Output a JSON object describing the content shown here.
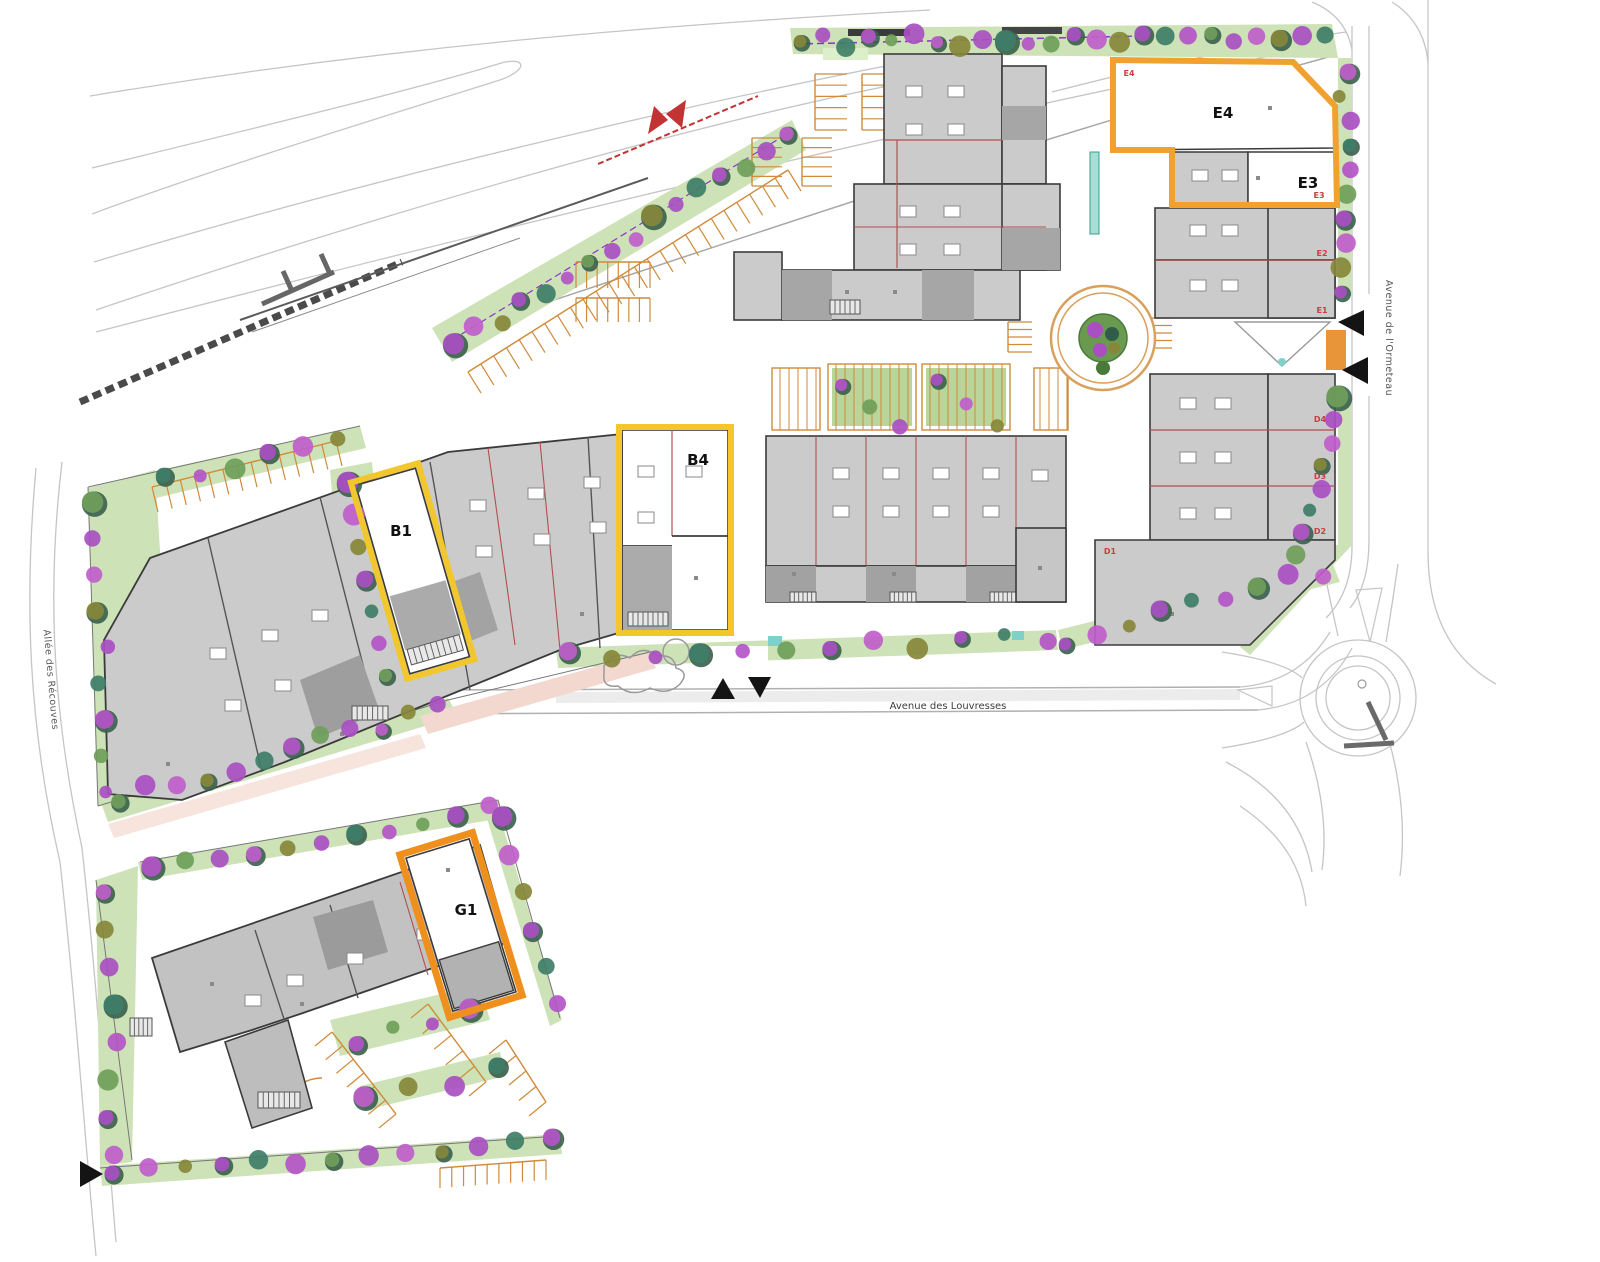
{
  "units": {
    "e4": {
      "label": "E4",
      "tag": "E4"
    },
    "e3": {
      "label": "E3",
      "tag": "E3"
    },
    "e2": {
      "tag": "E2"
    },
    "e1": {
      "tag": "E1"
    },
    "d4": {
      "tag": "D4"
    },
    "d3": {
      "tag": "D3"
    },
    "d2": {
      "tag": "D2"
    },
    "d1": {
      "tag": "D1"
    },
    "b4": {
      "label": "B4"
    },
    "b1": {
      "label": "B1"
    },
    "g1": {
      "label": "G1"
    }
  },
  "streets": {
    "louvresses": "Avenue des Louvresses",
    "ormeteau": "Avenue de l'Ormeteau",
    "recouves": "Allée des Récouves"
  },
  "colors": {
    "highlight_orange": "#F0A12F",
    "highlight_yellow": "#F2C72E",
    "highlight_deep_orange": "#EE8F1E",
    "unit_tag_red": "#C84040",
    "building_fill": "#CBCBCB",
    "building_dark": "#A6A6A6",
    "building_stroke": "#3B3B3B",
    "green_band": "#CDE2B6",
    "green_island": "#B9D59A",
    "tree_purple": "#A94FC2",
    "road_gray": "#C5C5C5",
    "parking_tan": "#CF8A3A",
    "rail_dark": "#4A4A4A",
    "power_line_red": "#C23333",
    "arrow_black": "#141414"
  }
}
